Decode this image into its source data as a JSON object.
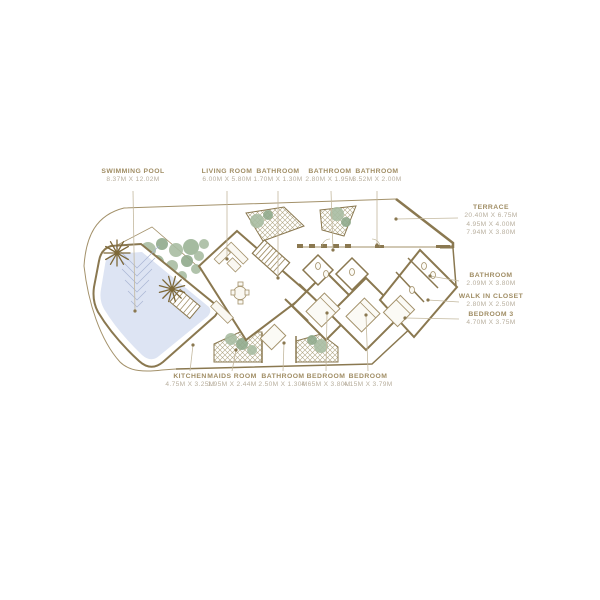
{
  "page": {
    "type": "residential floor plan"
  },
  "colors": {
    "wall": "#8a7850",
    "line": "#a3916a",
    "label_text": "#a08d64",
    "dims_text": "#b8af9e",
    "pool_water": "#dde4f3",
    "pool_contour": "#a9b5d3",
    "tree_green": "#a8bda2",
    "palm_brown": "#7d6838",
    "hatch_line": "#b0a583",
    "leader_line": "#c3b89e"
  },
  "labels": {
    "top": [
      {
        "name": "SWIMMING POOL",
        "dims": "8.37M X 12.02M"
      },
      {
        "name": "LIVING ROOM",
        "dims": "6.00M X 5.80M"
      },
      {
        "name": "BATHROOM",
        "dims": "1.70M X 1.30M"
      },
      {
        "name": "BATHROOM",
        "dims": "2.80M X 1.95M"
      },
      {
        "name": "BATHROOM",
        "dims": "3.52M X 2.00M"
      }
    ],
    "bottom": [
      {
        "name": "KITCHEN",
        "dims": "4.75M X 3.25M"
      },
      {
        "name": "MAIDS ROOM",
        "dims": "1.95M X 2.44M"
      },
      {
        "name": "BATHROOM",
        "dims": "2.50M X 1.30M"
      },
      {
        "name": "BEDROOM",
        "dims": "4.65M X 3.80M"
      },
      {
        "name": "BEDROOM",
        "dims": "4.15M X 3.79M"
      }
    ],
    "right": [
      {
        "name": "TERRACE",
        "dims": [
          "20.40M X 6.75M",
          "4.95M X 4.00M",
          "7.94M X 3.80M"
        ]
      },
      {
        "name": "BATHROOM",
        "dims": [
          "2.09M X 3.80M"
        ]
      },
      {
        "name": "WALK IN CLOSET",
        "dims": [
          "2.80M X 2.50M"
        ]
      },
      {
        "name": "BEDROOM 3",
        "dims": [
          "4.70M X 3.75M"
        ]
      }
    ]
  }
}
